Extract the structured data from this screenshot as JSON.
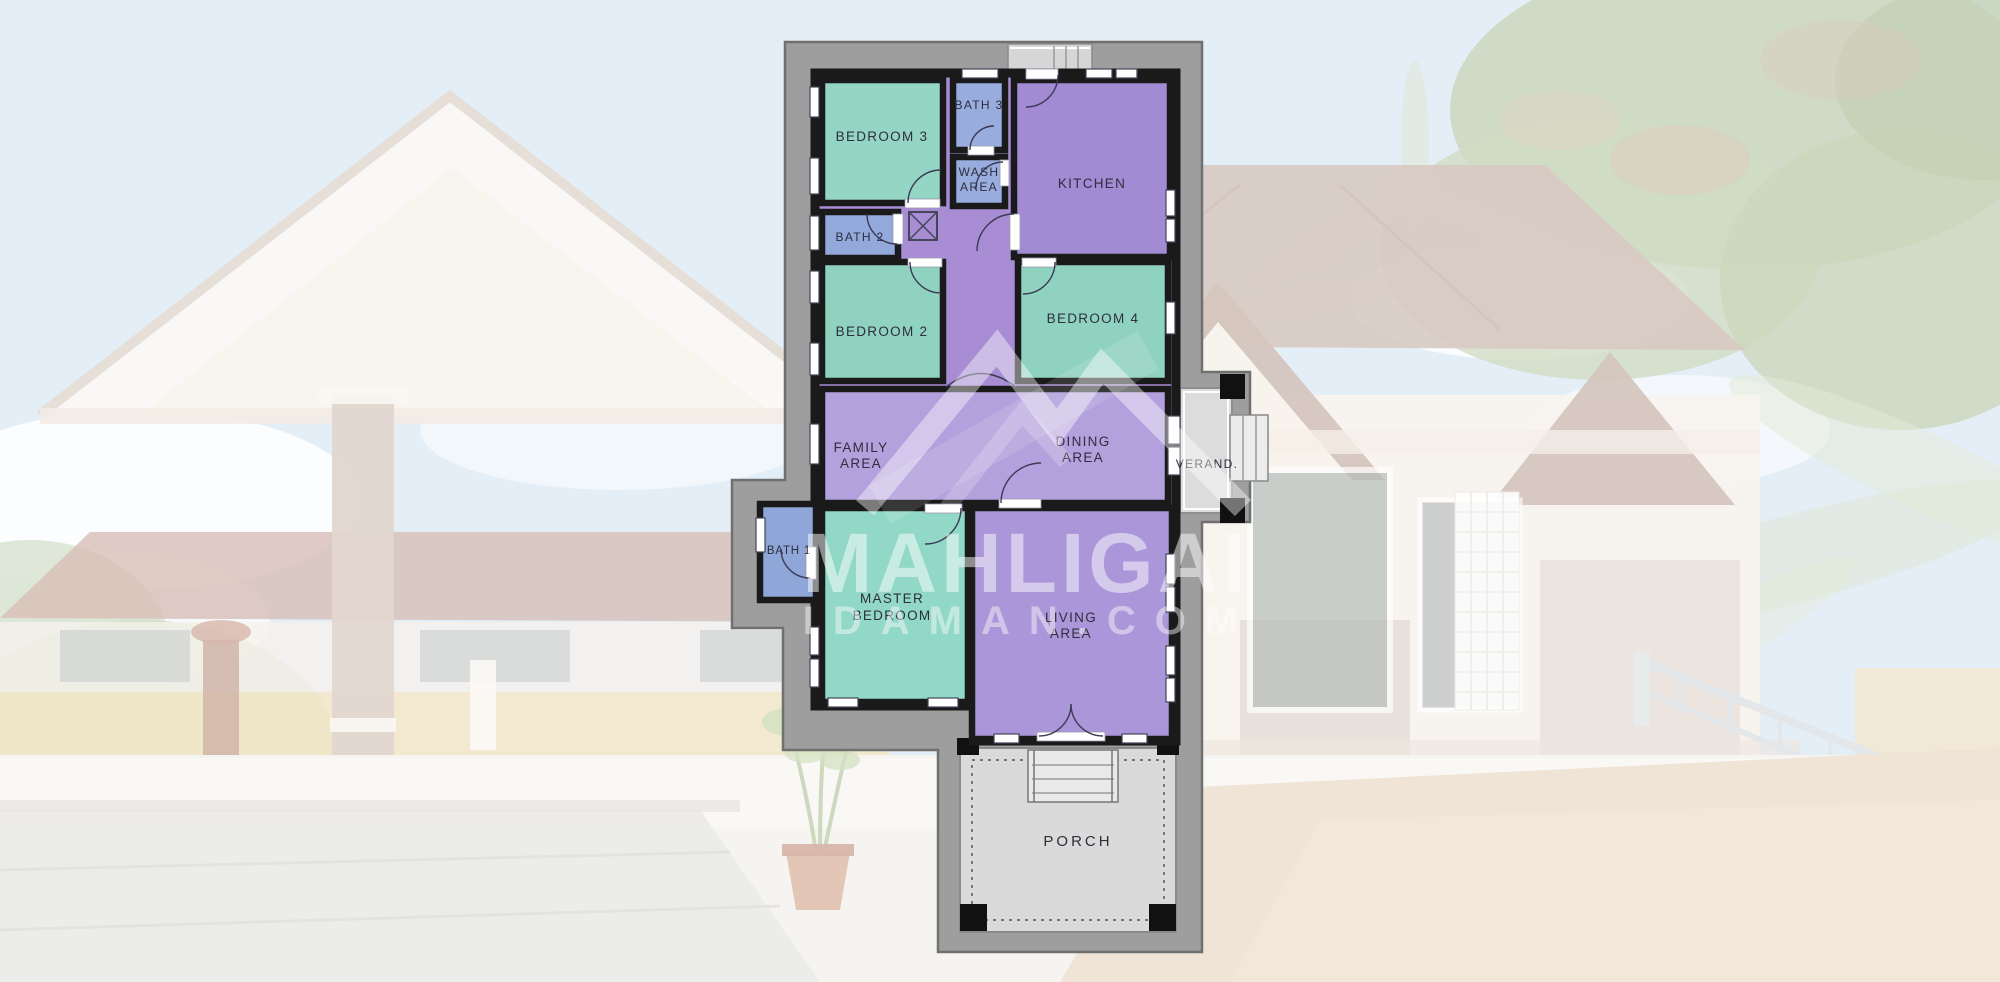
{
  "watermark": {
    "title": "MAHLIGAI",
    "domain": "IDAMAN.COM"
  },
  "plan": {
    "wall_color": "#1a1a1a",
    "hall_fill": "#a88dd4",
    "apron_fill": "#9e9e9e",
    "label_color": "#2e2e3c",
    "rooms": [
      {
        "id": "bedroom-3",
        "lines": [
          "BEDROOM 3"
        ],
        "fill": "#95d5c4"
      },
      {
        "id": "bath-3",
        "lines": [
          "BATH 3"
        ],
        "fill": "#98acde"
      },
      {
        "id": "wash-area",
        "lines": [
          "WASH",
          "AREA"
        ],
        "fill": "#98acde"
      },
      {
        "id": "kitchen",
        "lines": [
          "KITCHEN"
        ],
        "fill": "#a28bd2"
      },
      {
        "id": "bath-2",
        "lines": [
          "BATH 2"
        ],
        "fill": "#93a9db"
      },
      {
        "id": "bedroom-2",
        "lines": [
          "BEDROOM 2"
        ],
        "fill": "#90d2c0"
      },
      {
        "id": "bedroom-4",
        "lines": [
          "BEDROOM 4"
        ],
        "fill": "#90d2c0"
      },
      {
        "id": "family-area",
        "lines": [
          "FAMILY",
          "AREA"
        ],
        "fill": "#b3a1dd"
      },
      {
        "id": "dining-area",
        "lines": [
          "DINING",
          "AREA"
        ],
        "fill": "#b3a1dd"
      },
      {
        "id": "verandah",
        "lines": [
          "VERAND."
        ],
        "fill": "#dcdcdc"
      },
      {
        "id": "bath-1",
        "lines": [
          "BATH 1"
        ],
        "fill": "#8fa6d8"
      },
      {
        "id": "master-bedroom",
        "lines": [
          "MASTER",
          "BEDROOM"
        ],
        "fill": "#92d8c6"
      },
      {
        "id": "living-area",
        "lines": [
          "LIVING",
          "AREA"
        ],
        "fill": "#aa96d8"
      },
      {
        "id": "porch",
        "lines": [
          "PORCH"
        ],
        "fill": "#dadada"
      }
    ]
  }
}
